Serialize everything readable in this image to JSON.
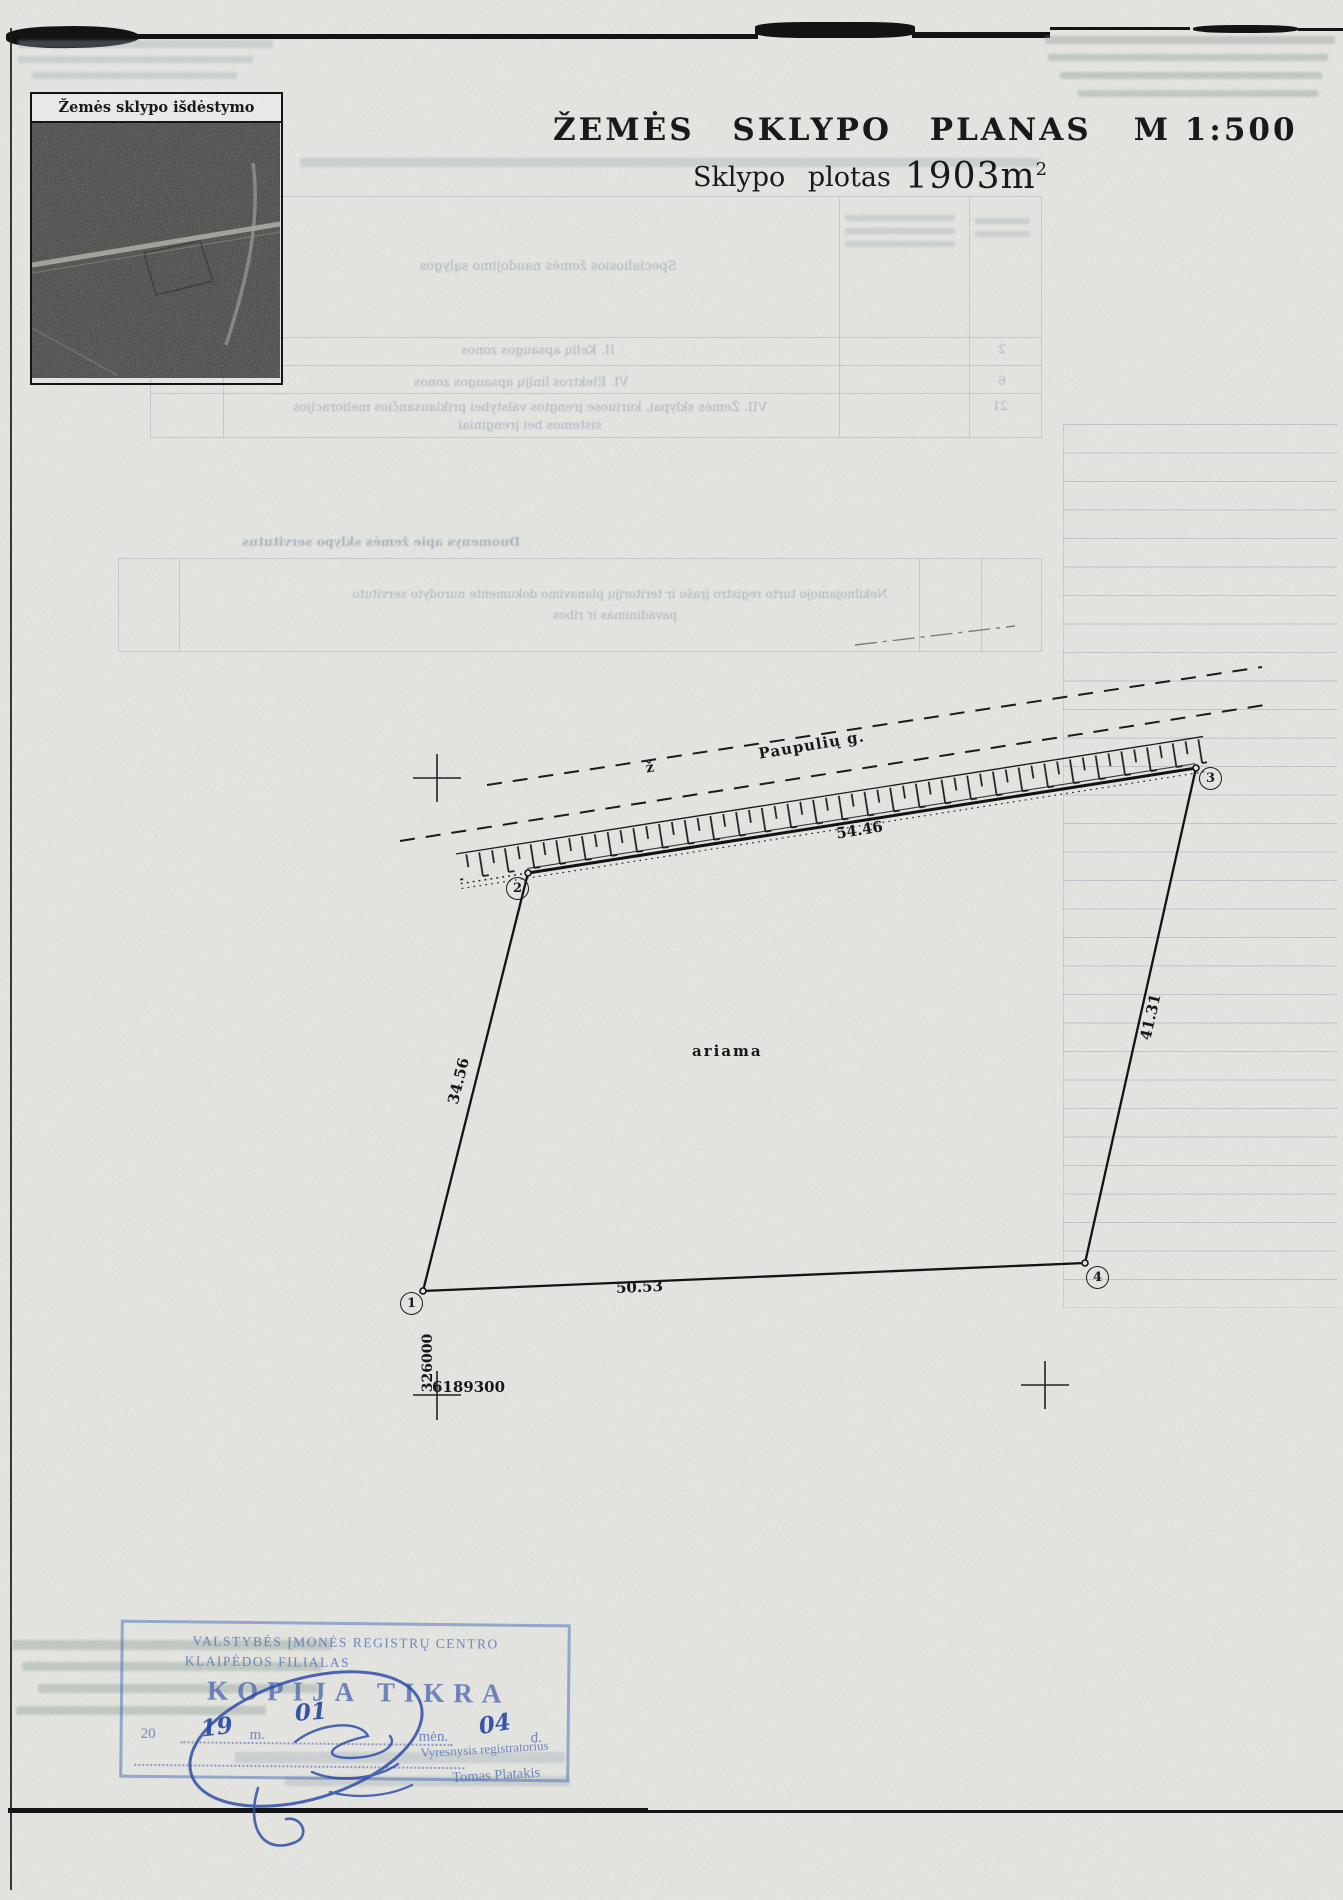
{
  "document": {
    "schema_caption": "Žemės sklypo išdėstymo schema",
    "title": "ŽEMĖS SKLYPO PLANAS",
    "scale": "M 1:500",
    "area_label": "Sklypo plotas",
    "area_value": "1903",
    "area_unit": "m",
    "area_exponent": "2"
  },
  "plan": {
    "street_name": "Paupulių g.",
    "marker_letter": "ž",
    "land_use": "ariama",
    "dimensions": {
      "top": "54.46",
      "right": "41.31",
      "bottom": "50.53",
      "left": "34.56"
    },
    "points": {
      "p1": "1",
      "p2": "2",
      "p3": "3",
      "p4": "4"
    },
    "grid": {
      "easting": "326000",
      "northing": "6189300"
    }
  },
  "bleedthrough": {
    "special_conditions_header": "Specialiosios žemės naudojimo sąlygos",
    "row1": "II. Kelių apsaugos zonos",
    "row2": "VI. Elektros linijų apsaugos zonos",
    "row3a": "VII. Žemės sklypai, kuriuose įrengtos valstybei priklausančios melioracijos",
    "row3b": "sistemos bei įrenginiai",
    "values": [
      "2",
      "6",
      "21"
    ],
    "servitudes_header": "Duomenys apie žemės sklypo servitutus",
    "servitudes_col_line1": "Nekilnojamojo turto registro įrašo ir teritorijų planavimo dokumente nurodyto servituto",
    "servitudes_col_line2": "pavadinimas ir ribos"
  },
  "stamp": {
    "org_line1": "VALSTYBĖS ĮMONĖS REGISTRŲ CENTRO",
    "org_line2": "KLAIPĖDOS FILIALAS",
    "copy_label": "KOPIJA TIKRA",
    "date_prefix": "20",
    "date_m_label": "m.",
    "date_men_label": "mėn.",
    "date_d_label": "d.",
    "hw_year": "19",
    "hw_month": "01",
    "hw_day": "04",
    "role": "Vyresnysis registratorius",
    "signer": "Tomas Platakis"
  }
}
